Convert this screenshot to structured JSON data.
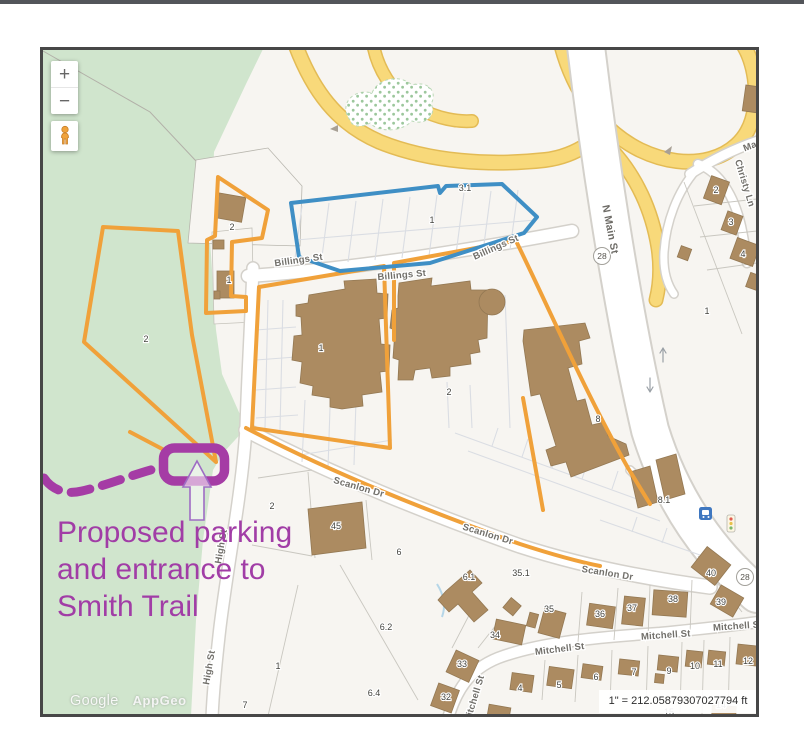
{
  "map": {
    "controls": {
      "zoom_in": "+",
      "zoom_out": "−",
      "pegman_icon": "pegman-street-view"
    },
    "attribution": {
      "google": "Google",
      "appgeo": "AppGeo"
    },
    "scale_text": "1\" = 212.05879307027794 ft",
    "colors": {
      "park_green": "#d0e5cd",
      "road_yellow": "#f8d97a",
      "building_brown": "#ac8b61",
      "parcel_orange": "#f0a13a",
      "parcel_blue": "#3f8fc5",
      "annotation_magenta": "#a53ca5",
      "base": "#f7f5f1"
    },
    "street_labels": [
      {
        "text": "Billings St",
        "x": 299,
        "y": 263,
        "rot": -8
      },
      {
        "text": "Billings St",
        "x": 402,
        "y": 278,
        "rot": -5
      },
      {
        "text": "Billings St",
        "x": 497,
        "y": 250,
        "rot": -24
      },
      {
        "text": "N Main St",
        "x": 607,
        "y": 230,
        "rot": 79,
        "cls": "major"
      },
      {
        "text": "Scanlon Dr",
        "x": 358,
        "y": 490,
        "rot": 16
      },
      {
        "text": "Scanlon Dr",
        "x": 487,
        "y": 537,
        "rot": 17
      },
      {
        "text": "Scanlon Dr",
        "x": 607,
        "y": 576,
        "rot": 9
      },
      {
        "text": "Mitchell St",
        "x": 560,
        "y": 652,
        "rot": -7
      },
      {
        "text": "Mitchell St",
        "x": 666,
        "y": 638,
        "rot": -4
      },
      {
        "text": "Mitchell St",
        "x": 738,
        "y": 629,
        "rot": -4
      },
      {
        "text": "Mitchell St",
        "x": 477,
        "y": 700,
        "rot": -73
      },
      {
        "text": "High St",
        "x": 224,
        "y": 547,
        "rot": -80
      },
      {
        "text": "High St",
        "x": 212,
        "y": 668,
        "rot": -80
      },
      {
        "text": "Christy Ln",
        "x": 742,
        "y": 184,
        "rot": 73
      },
      {
        "text": "Ma",
        "x": 751,
        "y": 149,
        "rot": -21
      }
    ],
    "route_shields": [
      {
        "text": "28",
        "x": 602,
        "y": 256
      },
      {
        "text": "28",
        "x": 745,
        "y": 577
      }
    ],
    "parcel_labels": [
      {
        "text": "3.1",
        "x": 465,
        "y": 191
      },
      {
        "text": "1",
        "x": 432,
        "y": 223
      },
      {
        "text": "2",
        "x": 232,
        "y": 230
      },
      {
        "text": "1",
        "x": 229,
        "y": 283
      },
      {
        "text": "2",
        "x": 146,
        "y": 342
      },
      {
        "text": "1",
        "x": 321,
        "y": 351
      },
      {
        "text": "2",
        "x": 449,
        "y": 395
      },
      {
        "text": "8",
        "x": 598,
        "y": 422
      },
      {
        "text": "8.1",
        "x": 664,
        "y": 503
      },
      {
        "text": "2",
        "x": 272,
        "y": 509
      },
      {
        "text": "45",
        "x": 336,
        "y": 529
      },
      {
        "text": "6",
        "x": 399,
        "y": 555
      },
      {
        "text": "6.1",
        "x": 469,
        "y": 580
      },
      {
        "text": "35.1",
        "x": 521,
        "y": 576
      },
      {
        "text": "6.2",
        "x": 386,
        "y": 630
      },
      {
        "text": "6.4",
        "x": 374,
        "y": 696
      },
      {
        "text": "34",
        "x": 495,
        "y": 638
      },
      {
        "text": "35",
        "x": 549,
        "y": 612
      },
      {
        "text": "33",
        "x": 462,
        "y": 667
      },
      {
        "text": "32",
        "x": 446,
        "y": 700
      },
      {
        "text": "36",
        "x": 600,
        "y": 617
      },
      {
        "text": "37",
        "x": 632,
        "y": 611
      },
      {
        "text": "38",
        "x": 673,
        "y": 602
      },
      {
        "text": "39",
        "x": 721,
        "y": 605
      },
      {
        "text": "40",
        "x": 711,
        "y": 576
      },
      {
        "text": "4",
        "x": 520,
        "y": 691
      },
      {
        "text": "5",
        "x": 559,
        "y": 688
      },
      {
        "text": "6",
        "x": 596,
        "y": 680
      },
      {
        "text": "7",
        "x": 634,
        "y": 675
      },
      {
        "text": "9",
        "x": 669,
        "y": 674
      },
      {
        "text": "10",
        "x": 695,
        "y": 669
      },
      {
        "text": "11",
        "x": 718,
        "y": 667
      },
      {
        "text": "12",
        "x": 748,
        "y": 664
      },
      {
        "text": "14",
        "x": 721,
        "y": 708
      },
      {
        "text": "15",
        "x": 669,
        "y": 715
      },
      {
        "text": "2",
        "x": 716,
        "y": 193
      },
      {
        "text": "3",
        "x": 731,
        "y": 225
      },
      {
        "text": "4",
        "x": 743,
        "y": 257
      },
      {
        "text": "1",
        "x": 707,
        "y": 314
      },
      {
        "text": "1",
        "x": 278,
        "y": 669
      },
      {
        "text": "7",
        "x": 245,
        "y": 708
      }
    ]
  },
  "annotation": {
    "lines": [
      "Proposed parking",
      "and entrance to",
      "Smith Trail"
    ],
    "color": "#a13da6"
  }
}
